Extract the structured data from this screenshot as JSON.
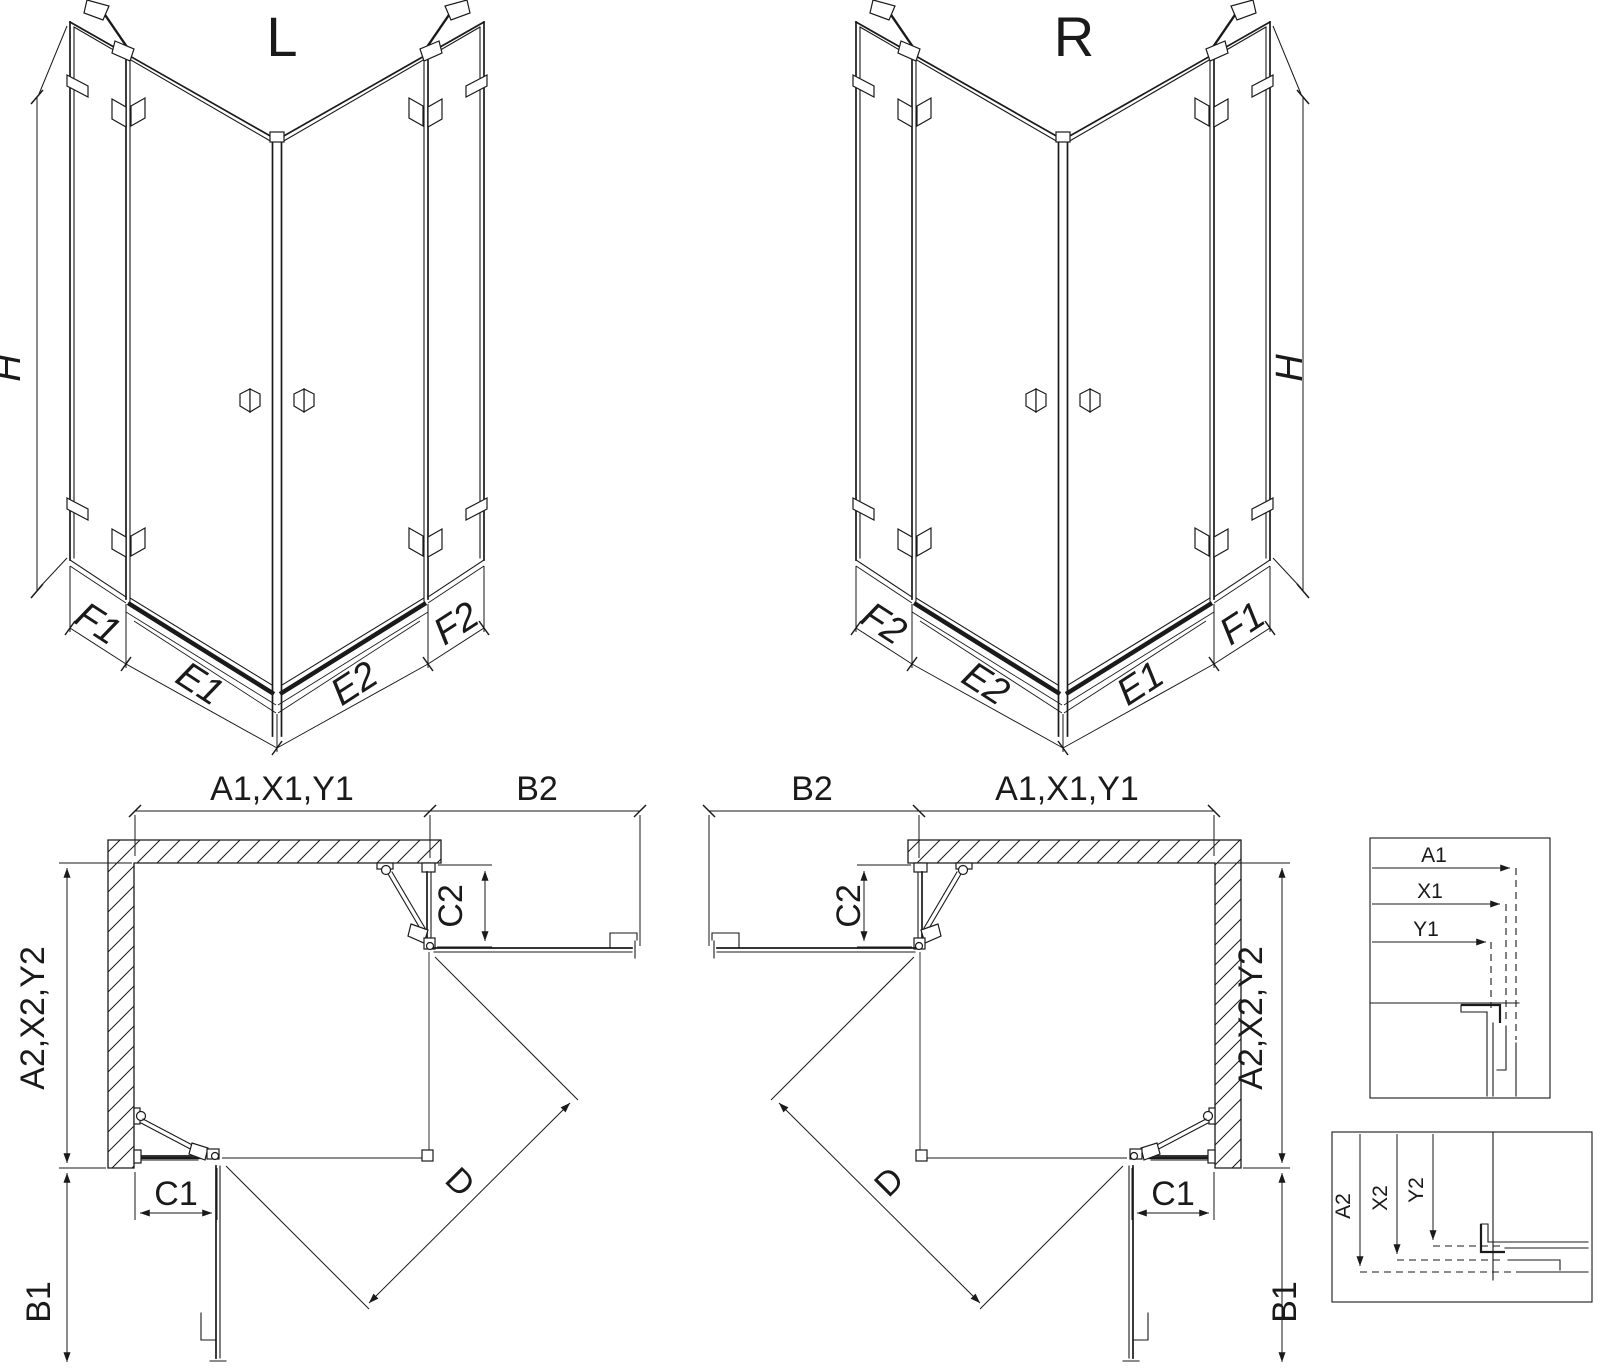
{
  "colors": {
    "line": "#1a1a1a",
    "background": "#ffffff"
  },
  "views": {
    "iso_left": {
      "title": "L",
      "height_label": "H",
      "bottom_dims": [
        "F1",
        "E1",
        "E2",
        "F2"
      ]
    },
    "iso_right": {
      "title": "R",
      "height_label": "H",
      "bottom_dims": [
        "F2",
        "E2",
        "E1",
        "F1"
      ]
    },
    "plan_left": {
      "width_top": "A1,X1,Y1",
      "open_door_top": "B2",
      "depth_side": "A2,X2,Y2",
      "open_door_side": "B1",
      "fixed_panel_bottom": "C1",
      "fixed_panel_side": "C2",
      "diagonal_entry": "D"
    },
    "plan_right": {
      "width_top": "A1,X1,Y1",
      "open_door_top": "B2",
      "depth_side": "A2,X2,Y2",
      "open_door_side": "B1",
      "fixed_panel_bottom": "C1",
      "fixed_panel_side": "C2",
      "diagonal_entry": "D"
    },
    "detail_width": {
      "dims": [
        "A1",
        "X1",
        "Y1"
      ]
    },
    "detail_depth": {
      "dims": [
        "A2",
        "X2",
        "Y2"
      ]
    }
  }
}
